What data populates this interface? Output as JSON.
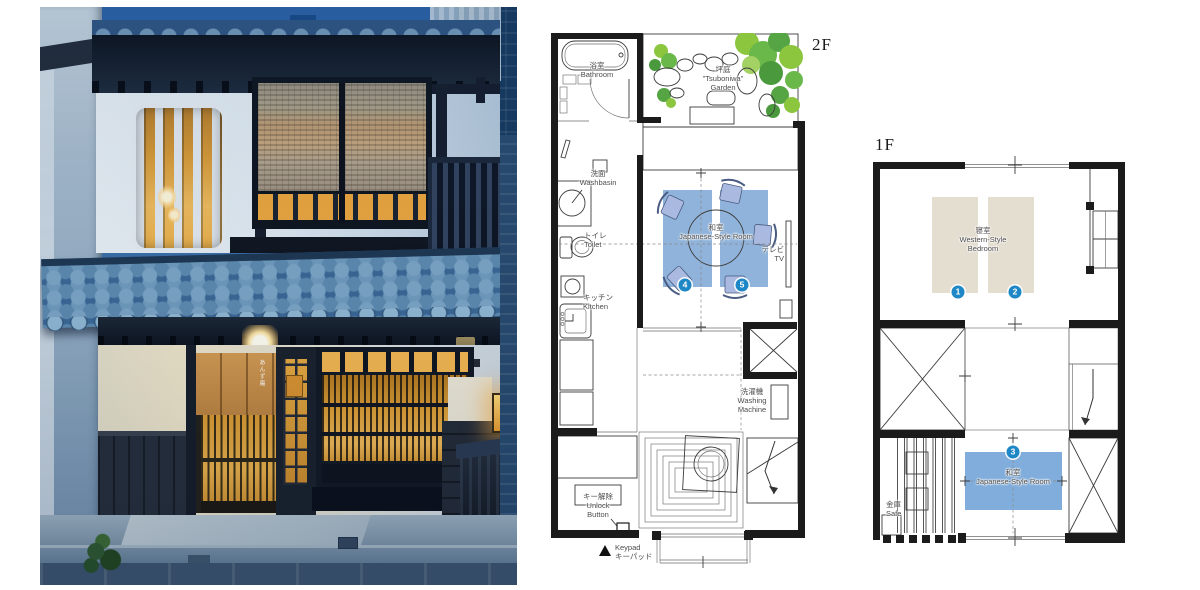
{
  "photo": {
    "noren_text": "あんず庵"
  },
  "plans": {
    "f2": {
      "floor_label": "2F",
      "bathroom_jp": "浴室",
      "bathroom_en": "Bathroom",
      "garden_jp": "坪庭",
      "garden_en1": "\"Tsuboniwa\"",
      "garden_en2": "Garden",
      "washbasin_jp": "洗面",
      "washbasin_en": "Washbasin",
      "toilet_jp": "トイレ",
      "toilet_en": "Toilet",
      "kitchen_jp": "キッチン",
      "kitchen_en": "Kitchen",
      "washitsu_jp": "和室",
      "washitsu_en": "Japanese-Style Room",
      "tv_jp": "テレビ",
      "tv_en": "TV",
      "washing_jp": "洗濯機",
      "washing_en1": "Washing",
      "washing_en2": "Machine",
      "unlock_jp": "キー解除",
      "unlock_en1": "Unlock",
      "unlock_en2": "Button",
      "keypad_en": "Keypad",
      "keypad_jp": "キーパッド",
      "badge4": "4",
      "badge5": "5"
    },
    "f1": {
      "floor_label": "1F",
      "bedroom_jp": "寝室",
      "bedroom_en1": "Western-Style",
      "bedroom_en2": "Bedroom",
      "washitsu_jp": "和室",
      "washitsu_en": "Japanese-Style Room",
      "safe_jp": "金庫",
      "safe_en": "Safe",
      "badge1": "1",
      "badge2": "2",
      "badge3": "3"
    }
  },
  "colors": {
    "tatami_blue": "#8FB3DA",
    "room_blue": "#80ADDB",
    "bed_beige": "#E4DED1",
    "badge_blue": "#1E87C5",
    "plan_wall": "#1B1B1B",
    "foliage_green": "#6AB84A"
  }
}
